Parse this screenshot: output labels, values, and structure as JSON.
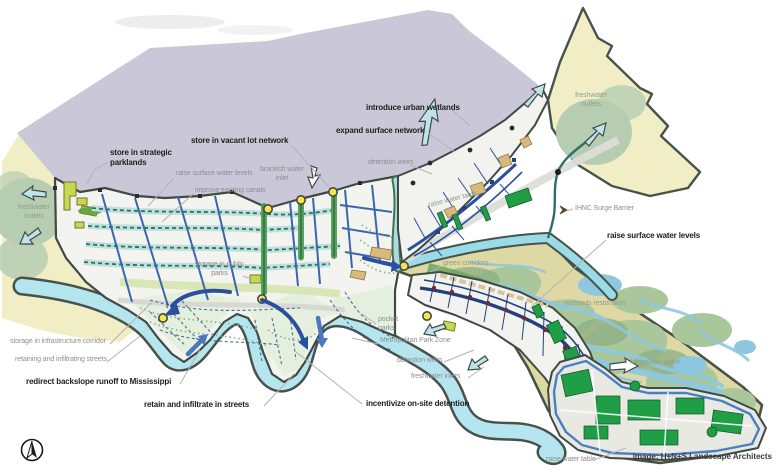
{
  "figure": {
    "credit": "image: H+N+S Landscape Architects",
    "palette": {
      "lake": "#cac8d8",
      "marsh": "#f1eec6",
      "sage": "#b7cdb2",
      "wetland_tan": "#ded9a4",
      "wetland_stream_blue": "#8ec8e0",
      "river_cyan": "#b5e6f0",
      "outline_olive": "#47524a",
      "canal_blue": "#3a66ac",
      "park_green": "#1f9e45",
      "node_yellow": "#f6e64b",
      "label_grey": "#8e8e8e",
      "label_dark": "#1d1d1d"
    }
  },
  "annotations": {
    "bold": [
      {
        "text": "store in strategic parklands"
      },
      {
        "text": "store in vacant lot network"
      },
      {
        "text": "introduce urban wetlands"
      },
      {
        "text": "expand surface network"
      },
      {
        "text": "raise surface water levels"
      },
      {
        "text": "redirect backslope runoff to Mississippi"
      },
      {
        "text": "retain and infiltrate in streets"
      },
      {
        "text": "incentivize on-site detention"
      }
    ],
    "small": [
      {
        "text": "freshwater outlets"
      },
      {
        "text": "raise surface water levels"
      },
      {
        "text": "improve existing canals"
      },
      {
        "text": "brackish water inlet"
      },
      {
        "text": "detention weirs"
      },
      {
        "text": "freshwater outlets"
      },
      {
        "text": "IHNC Surge Barrier"
      },
      {
        "text": "raise water table"
      },
      {
        "text": "storage in public parks"
      },
      {
        "text": "storage in infrastructure corridor"
      },
      {
        "text": "retaining and infiltrating streets"
      },
      {
        "text": "pocket parks"
      },
      {
        "text": "Metropolitan Park Zone"
      },
      {
        "text": "detention weirs"
      },
      {
        "text": "freshwater inlets"
      },
      {
        "text": "green corridors"
      },
      {
        "text": "wetlands restoration"
      },
      {
        "text": "freshwater outlet"
      },
      {
        "text": "raise water table"
      }
    ]
  }
}
